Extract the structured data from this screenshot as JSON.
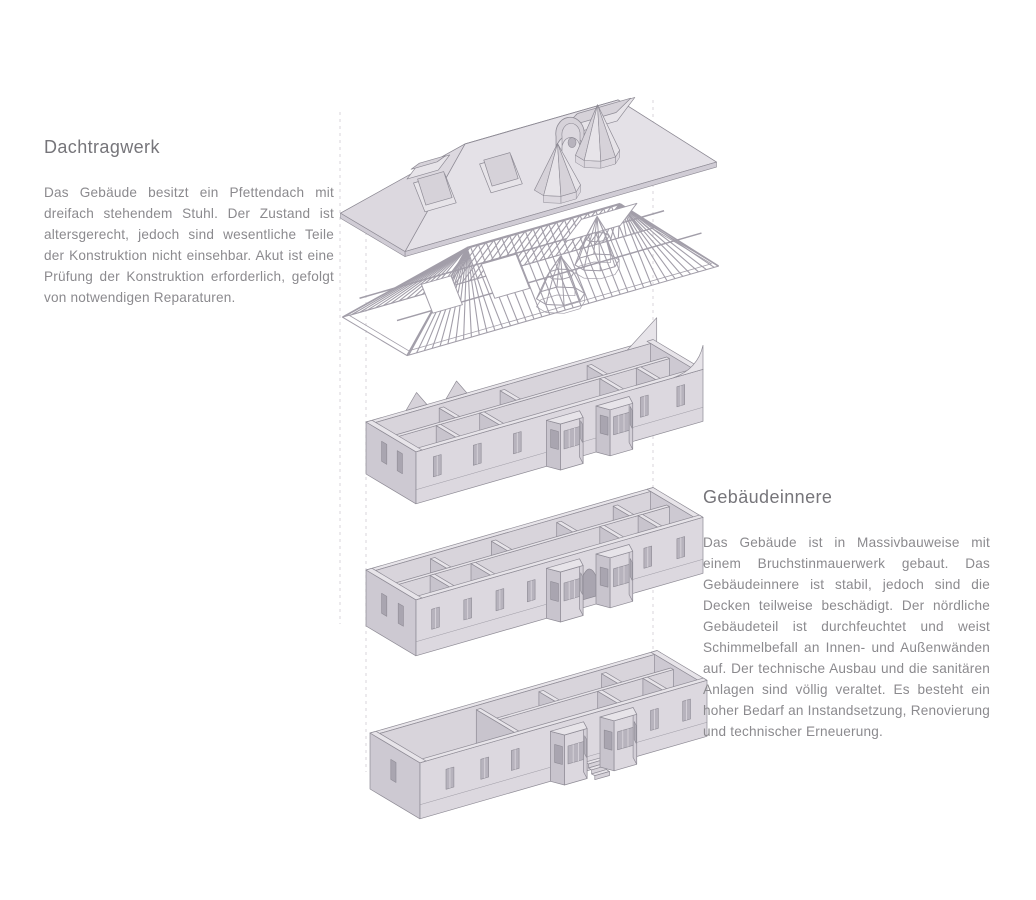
{
  "sections": {
    "dachtragwerk": {
      "title": "Dachtragwerk",
      "body": "Das Gebäude besitzt ein Pfettendach mit dreifach stehendem Stuhl. Der Zustand ist altersgerecht, jedoch sind wesentliche Teile der Konstruktion nicht einsehbar. Akut ist eine Prüfung der Konstruktion erforderlich, gefolgt von notwendigen Reparaturen."
    },
    "gebaeudeinnere": {
      "title": "Gebäudeinnere",
      "body": "Das Gebäude ist in Massivbauweise mit einem Bruchstinmauerwerk gebaut.  Das Gebäudeinnere ist stabil, jedoch sind die Decken teilweise beschädigt. Der nördliche Gebäudeteil ist durchfeuchtet und weist Schimmelbefall an Innen- und Außenwänden auf. Der technische Ausbau und die sanitären Anlagen sind völlig veraltet. Es besteht ein hoher Bedarf an Instandsetzung, Renovierung und technischer Erneuerung."
    }
  },
  "diagram": {
    "colors": {
      "light": "#e7e4e9",
      "facade": "#dcd8df",
      "mid": "#d6d2d9",
      "inner": "#d8d4db",
      "endwall": "#cdc9d2",
      "wallside": "#c8c4cd",
      "floor": "#ddd9e0",
      "glass": "#b7b3bd",
      "glassdark": "#a9a5b0",
      "slope_front": "#e4e1e7",
      "slope_back": "#e0dde3",
      "hip_left": "#dcd8df",
      "hip_right": "#d3cfd7",
      "fascia": "#d0ccd5",
      "line": "#8e8b95",
      "frame": "#a29ea9",
      "guide": "#d8d6db",
      "white": "#ffffff"
    }
  }
}
